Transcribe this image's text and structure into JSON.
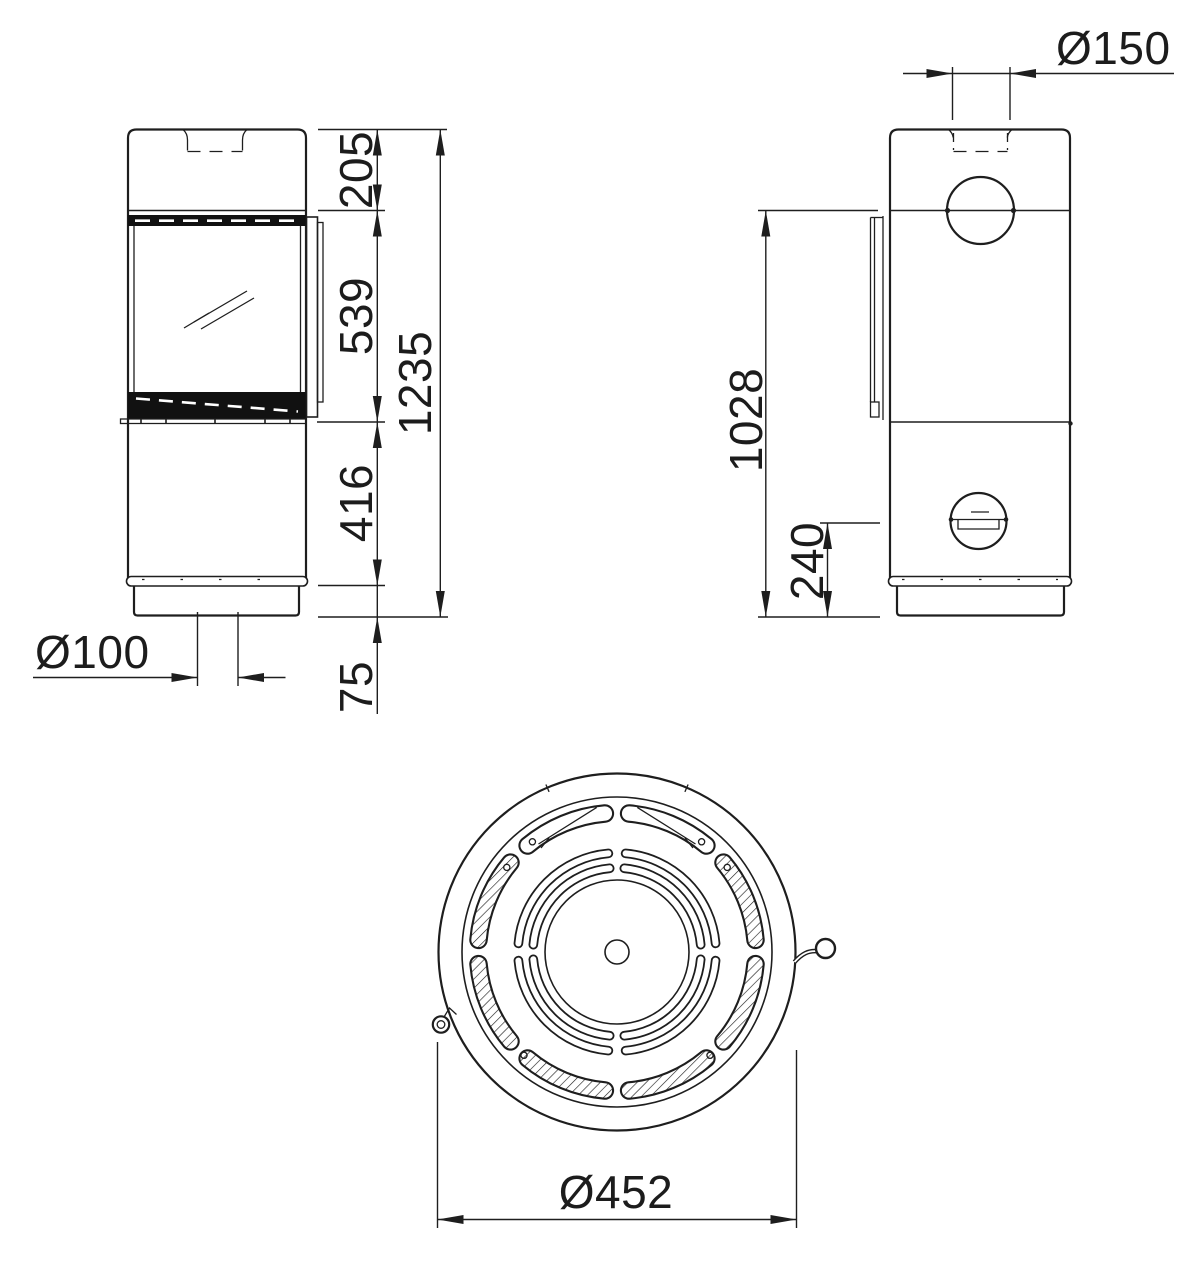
{
  "drawing": {
    "background": "#ffffff",
    "line_color": "#1e1e1e",
    "dims": {
      "top_section_height": "205",
      "door_height": "539",
      "lower_body_height": "416",
      "plinth_height": "75",
      "total_height": "1235",
      "floor_inlet_diameter": "Ø100",
      "flue_diameter": "Ø150",
      "rear_flue_center_height": "1028",
      "rear_inlet_center_height": "240",
      "body_diameter": "Ø452"
    }
  }
}
